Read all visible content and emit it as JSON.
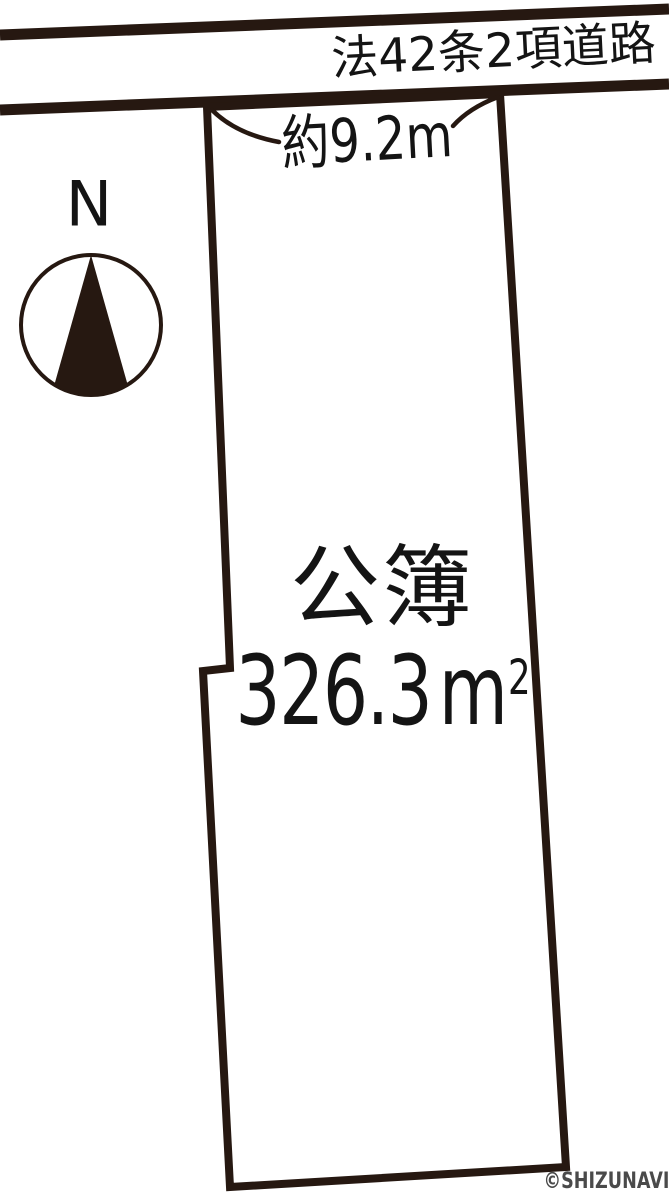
{
  "road": {
    "label": "法42条2項道路"
  },
  "frontage": {
    "label": "約9.2m"
  },
  "parcel": {
    "register_label": "公簿",
    "area_value": "326.3",
    "area_unit": "m",
    "area_exponent": "2"
  },
  "compass": {
    "north_label": "N"
  },
  "footer": {
    "copyright": "©SHIZUNAVI"
  },
  "colors": {
    "outline": "#261811",
    "parcel_fill": "#EBC79E",
    "label_text": "#141414",
    "copyright_text": "#4A4A4A",
    "background": "#FFFFFF"
  }
}
